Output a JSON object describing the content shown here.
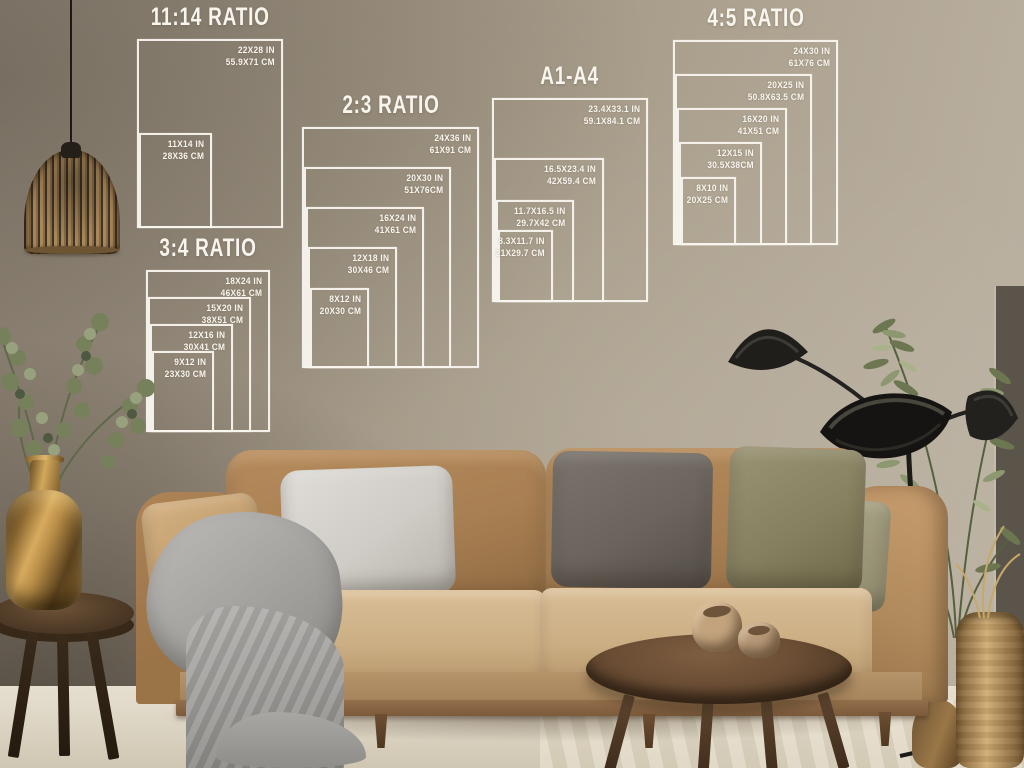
{
  "charts": [
    {
      "id": "ratio-11-14",
      "title": "11:14 RATIO",
      "pos": {
        "x": 137,
        "y": 39,
        "w": 146,
        "h": 189
      },
      "sizes": [
        {
          "in": "22X28 IN",
          "cm": "55.9X71 CM",
          "fw": 1,
          "fh": 1
        },
        {
          "in": "11X14 IN",
          "cm": "28X36 CM",
          "fw": 0.5,
          "fh": 0.5
        }
      ]
    },
    {
      "id": "ratio-2-3",
      "title": "2:3 RATIO",
      "pos": {
        "x": 302,
        "y": 127,
        "w": 177,
        "h": 241
      },
      "sizes": [
        {
          "in": "24X36 IN",
          "cm": "61X91 CM",
          "fw": 1,
          "fh": 1
        },
        {
          "in": "20X30 IN",
          "cm": "51X76CM",
          "fw": 0.833,
          "fh": 0.833
        },
        {
          "in": "16X24 IN",
          "cm": "41X61 CM",
          "fw": 0.667,
          "fh": 0.667
        },
        {
          "in": "12X18 IN",
          "cm": "30X46 CM",
          "fw": 0.5,
          "fh": 0.5
        },
        {
          "in": "8X12 IN",
          "cm": "20X30 CM",
          "fw": 0.333,
          "fh": 0.333
        }
      ]
    },
    {
      "id": "ratio-3-4",
      "title": "3:4 RATIO",
      "pos": {
        "x": 146,
        "y": 270,
        "w": 124,
        "h": 162
      },
      "sizes": [
        {
          "in": "18X24 IN",
          "cm": "46X61 CM",
          "fw": 1,
          "fh": 1
        },
        {
          "in": "15X20 IN",
          "cm": "38X51 CM",
          "fw": 0.833,
          "fh": 0.833
        },
        {
          "in": "12X16 IN",
          "cm": "30X41 CM",
          "fw": 0.667,
          "fh": 0.667
        },
        {
          "in": "9X12 IN",
          "cm": "23X30 CM",
          "fw": 0.5,
          "fh": 0.5
        }
      ]
    },
    {
      "id": "a1-a4",
      "title": "A1-A4",
      "pos": {
        "x": 492,
        "y": 98,
        "w": 156,
        "h": 204
      },
      "sizes": [
        {
          "in": "23.4X33.1 IN",
          "cm": "59.1X84.1 CM",
          "fw": 1,
          "fh": 1
        },
        {
          "in": "16.5X23.4 IN",
          "cm": "42X59.4 CM",
          "fw": 0.705,
          "fh": 0.707
        },
        {
          "in": "11.7X16.5 IN",
          "cm": "29.7X42 CM",
          "fw": 0.5,
          "fh": 0.498
        },
        {
          "in": "8.3X11.7 IN",
          "cm": "21X29.7 CM",
          "fw": 0.355,
          "fh": 0.353
        }
      ]
    },
    {
      "id": "ratio-4-5",
      "title": "4:5 RATIO",
      "pos": {
        "x": 673,
        "y": 40,
        "w": 165,
        "h": 205
      },
      "sizes": [
        {
          "in": "24X30 IN",
          "cm": "61X76 CM",
          "fw": 1,
          "fh": 1
        },
        {
          "in": "20X25 IN",
          "cm": "50.8X63.5 CM",
          "fw": 0.833,
          "fh": 0.833
        },
        {
          "in": "16X20 IN",
          "cm": "41X51 CM",
          "fw": 0.667,
          "fh": 0.667
        },
        {
          "in": "12X15 IN",
          "cm": "30.5X38CM",
          "fw": 0.5,
          "fh": 0.5
        },
        {
          "in": "8X10 IN",
          "cm": "20X25 CM",
          "fw": 0.333,
          "fh": 0.333
        }
      ]
    }
  ],
  "overlay": {
    "line_color": "#f8f5ee",
    "text_color": "#f8f5ee"
  },
  "scene": {
    "items": [
      "pendant-lamp",
      "eucalyptus-plant",
      "brass-vase",
      "side-table",
      "sofa",
      "throw-blanket",
      "pillows",
      "coffee-table",
      "ceramic-bowls",
      "floor-lamp",
      "potted-tree",
      "woven-vase"
    ],
    "colors": {
      "wall": "#a69a89",
      "floor": "#ddd5c4",
      "sofa_tan": "#a87f52",
      "seat_tan": "#cbae83",
      "pillow_light_gray": "#cfccc6",
      "pillow_dark_gray": "#6b645d",
      "pillow_olive": "#868060",
      "blanket_gray": "#a5a3a0",
      "wood_dark": "#4e3a26",
      "brass": "#c49a52",
      "lamp_black": "#1f1d1a",
      "plant_green": "#76815c"
    }
  }
}
